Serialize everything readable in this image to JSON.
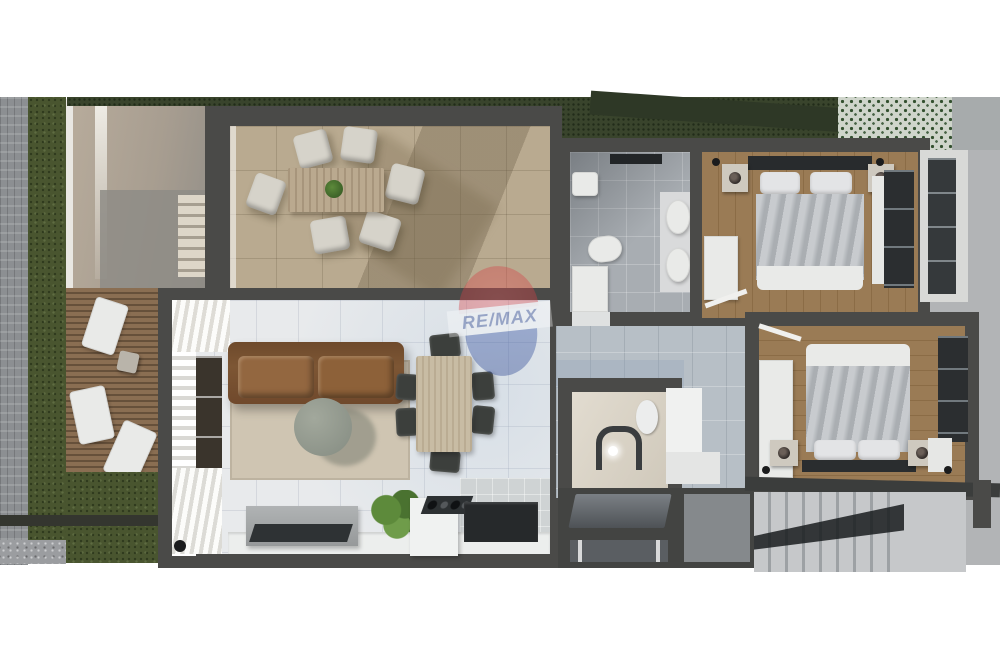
{
  "watermark": {
    "text": "RE/MAX",
    "opacity": 0.38
  },
  "palette": {
    "wall": "#4a4a48",
    "remax_red": "#cf3a3e",
    "remax_blue": "#27418f",
    "grass_green": "#49552f",
    "terrace_tile": "#b9aa90",
    "marble_white": "#e8eaec",
    "hall_marble": "#b7bfc6",
    "bath_tile": "#a8adb2",
    "bedroom_wood": "#96774f",
    "deck_wood": "#8a6e52",
    "stone_gray": "#8c8f92",
    "exterior_concrete": "#b2b4b6",
    "sofa_brown": "#7d5634",
    "rug_beige": "#cfc5b2",
    "duvet_gray": "#b9bdc1",
    "stair_light": "#c6c8ca"
  }
}
